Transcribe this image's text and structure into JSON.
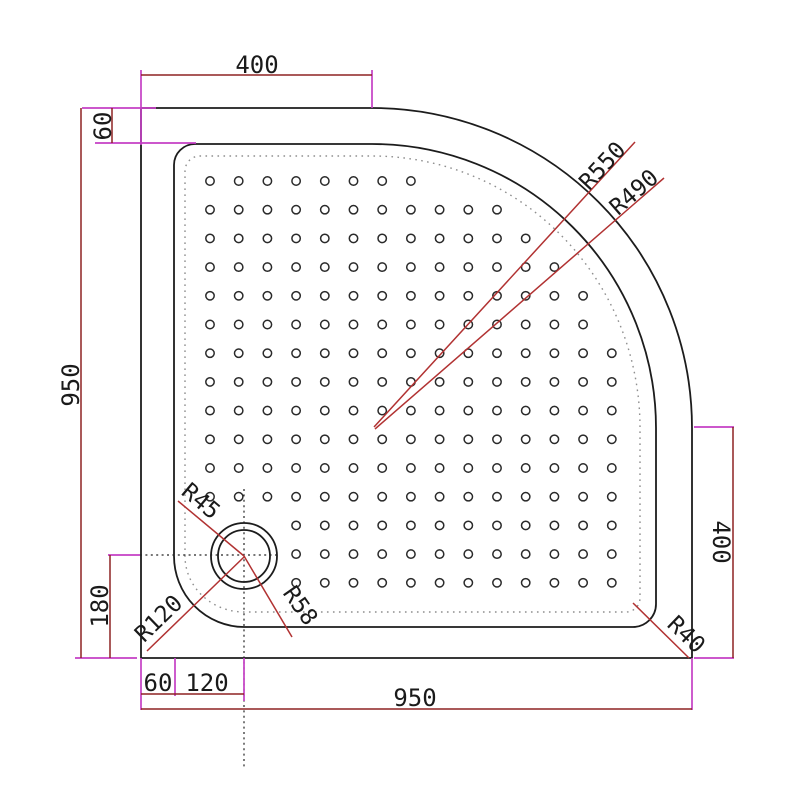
{
  "dims": {
    "top_width": "400",
    "rim_top": "60",
    "left_height": "950",
    "right_height": "400",
    "drain_from_bottom": "180",
    "rim_left": "60",
    "drain_from_rim": "120",
    "bottom_width": "950"
  },
  "radii": {
    "outer_corner": "R550",
    "inner_corner": "R490",
    "drain_hole": "R45",
    "drain_flange": "R58",
    "basin_corner": "R120",
    "rim_corner": "R40"
  },
  "colors": {
    "background": "#ffffff",
    "outline": "#1c1c1c",
    "dim_line": "#8e2222",
    "leader_line": "#b13232",
    "extension_line": "#c43fc4",
    "text": "#1a1a1a",
    "dot_outline": "#2a2a2a"
  }
}
